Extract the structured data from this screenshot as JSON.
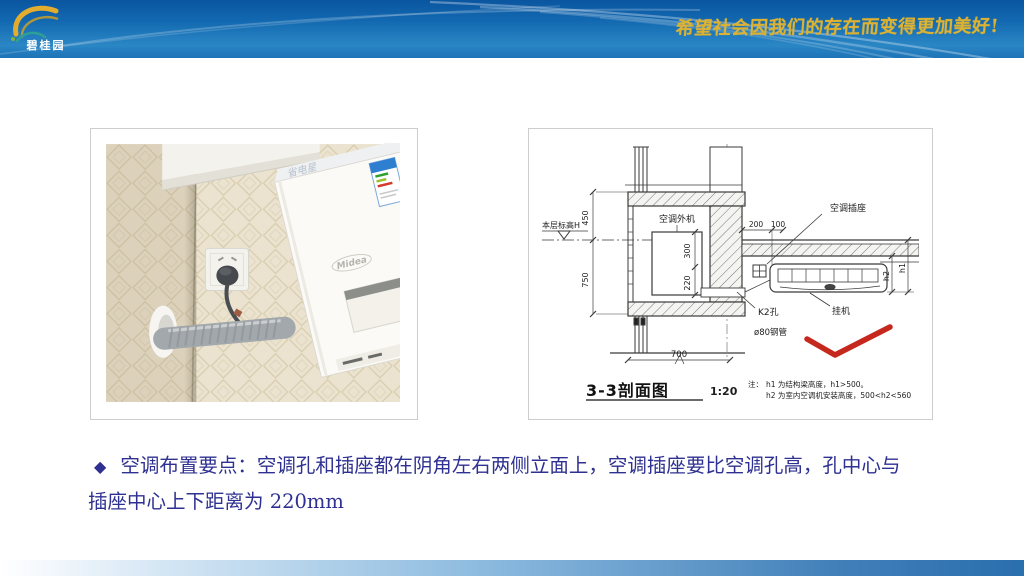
{
  "header": {
    "logo_text": "碧桂园",
    "slogan": "希望社会因我们的存在而变得更加美好!"
  },
  "photo": {
    "brand": "Midea",
    "series_text": "省电星"
  },
  "drawing": {
    "title": "3-3剖面图",
    "scale": "1:20",
    "labels": {
      "level_mark": "本层标高H",
      "outdoor_unit": "空调外机",
      "socket": "空调插座",
      "indoor_unit": "挂机",
      "hole": "K2孔",
      "pipe": "ø80钢管"
    },
    "dims": {
      "d450": "450",
      "d750": "750",
      "d300": "300",
      "d220": "220",
      "d200": "200",
      "d100": "100",
      "d700": "700",
      "h1": "h1",
      "h2": "h2"
    },
    "note": {
      "prefix": "注：",
      "line1": "h1 为结构梁高度，h1>500。",
      "line2": "h2 为室内空调机安装高度，500<h2<560"
    }
  },
  "bullet": {
    "marker": "◆",
    "line1": "空调布置要点：空调孔和插座都在阴角左右两侧立面上，空调插座要比空调孔高，孔中心与",
    "line2": "插座中心上下距离为 220mm"
  },
  "colors": {
    "header_top": "#0a55a0",
    "header_bottom": "#2b86c4",
    "slogan_gold": "#dcb233",
    "text_navy": "#2f3192",
    "check_red": "#c5281c"
  }
}
